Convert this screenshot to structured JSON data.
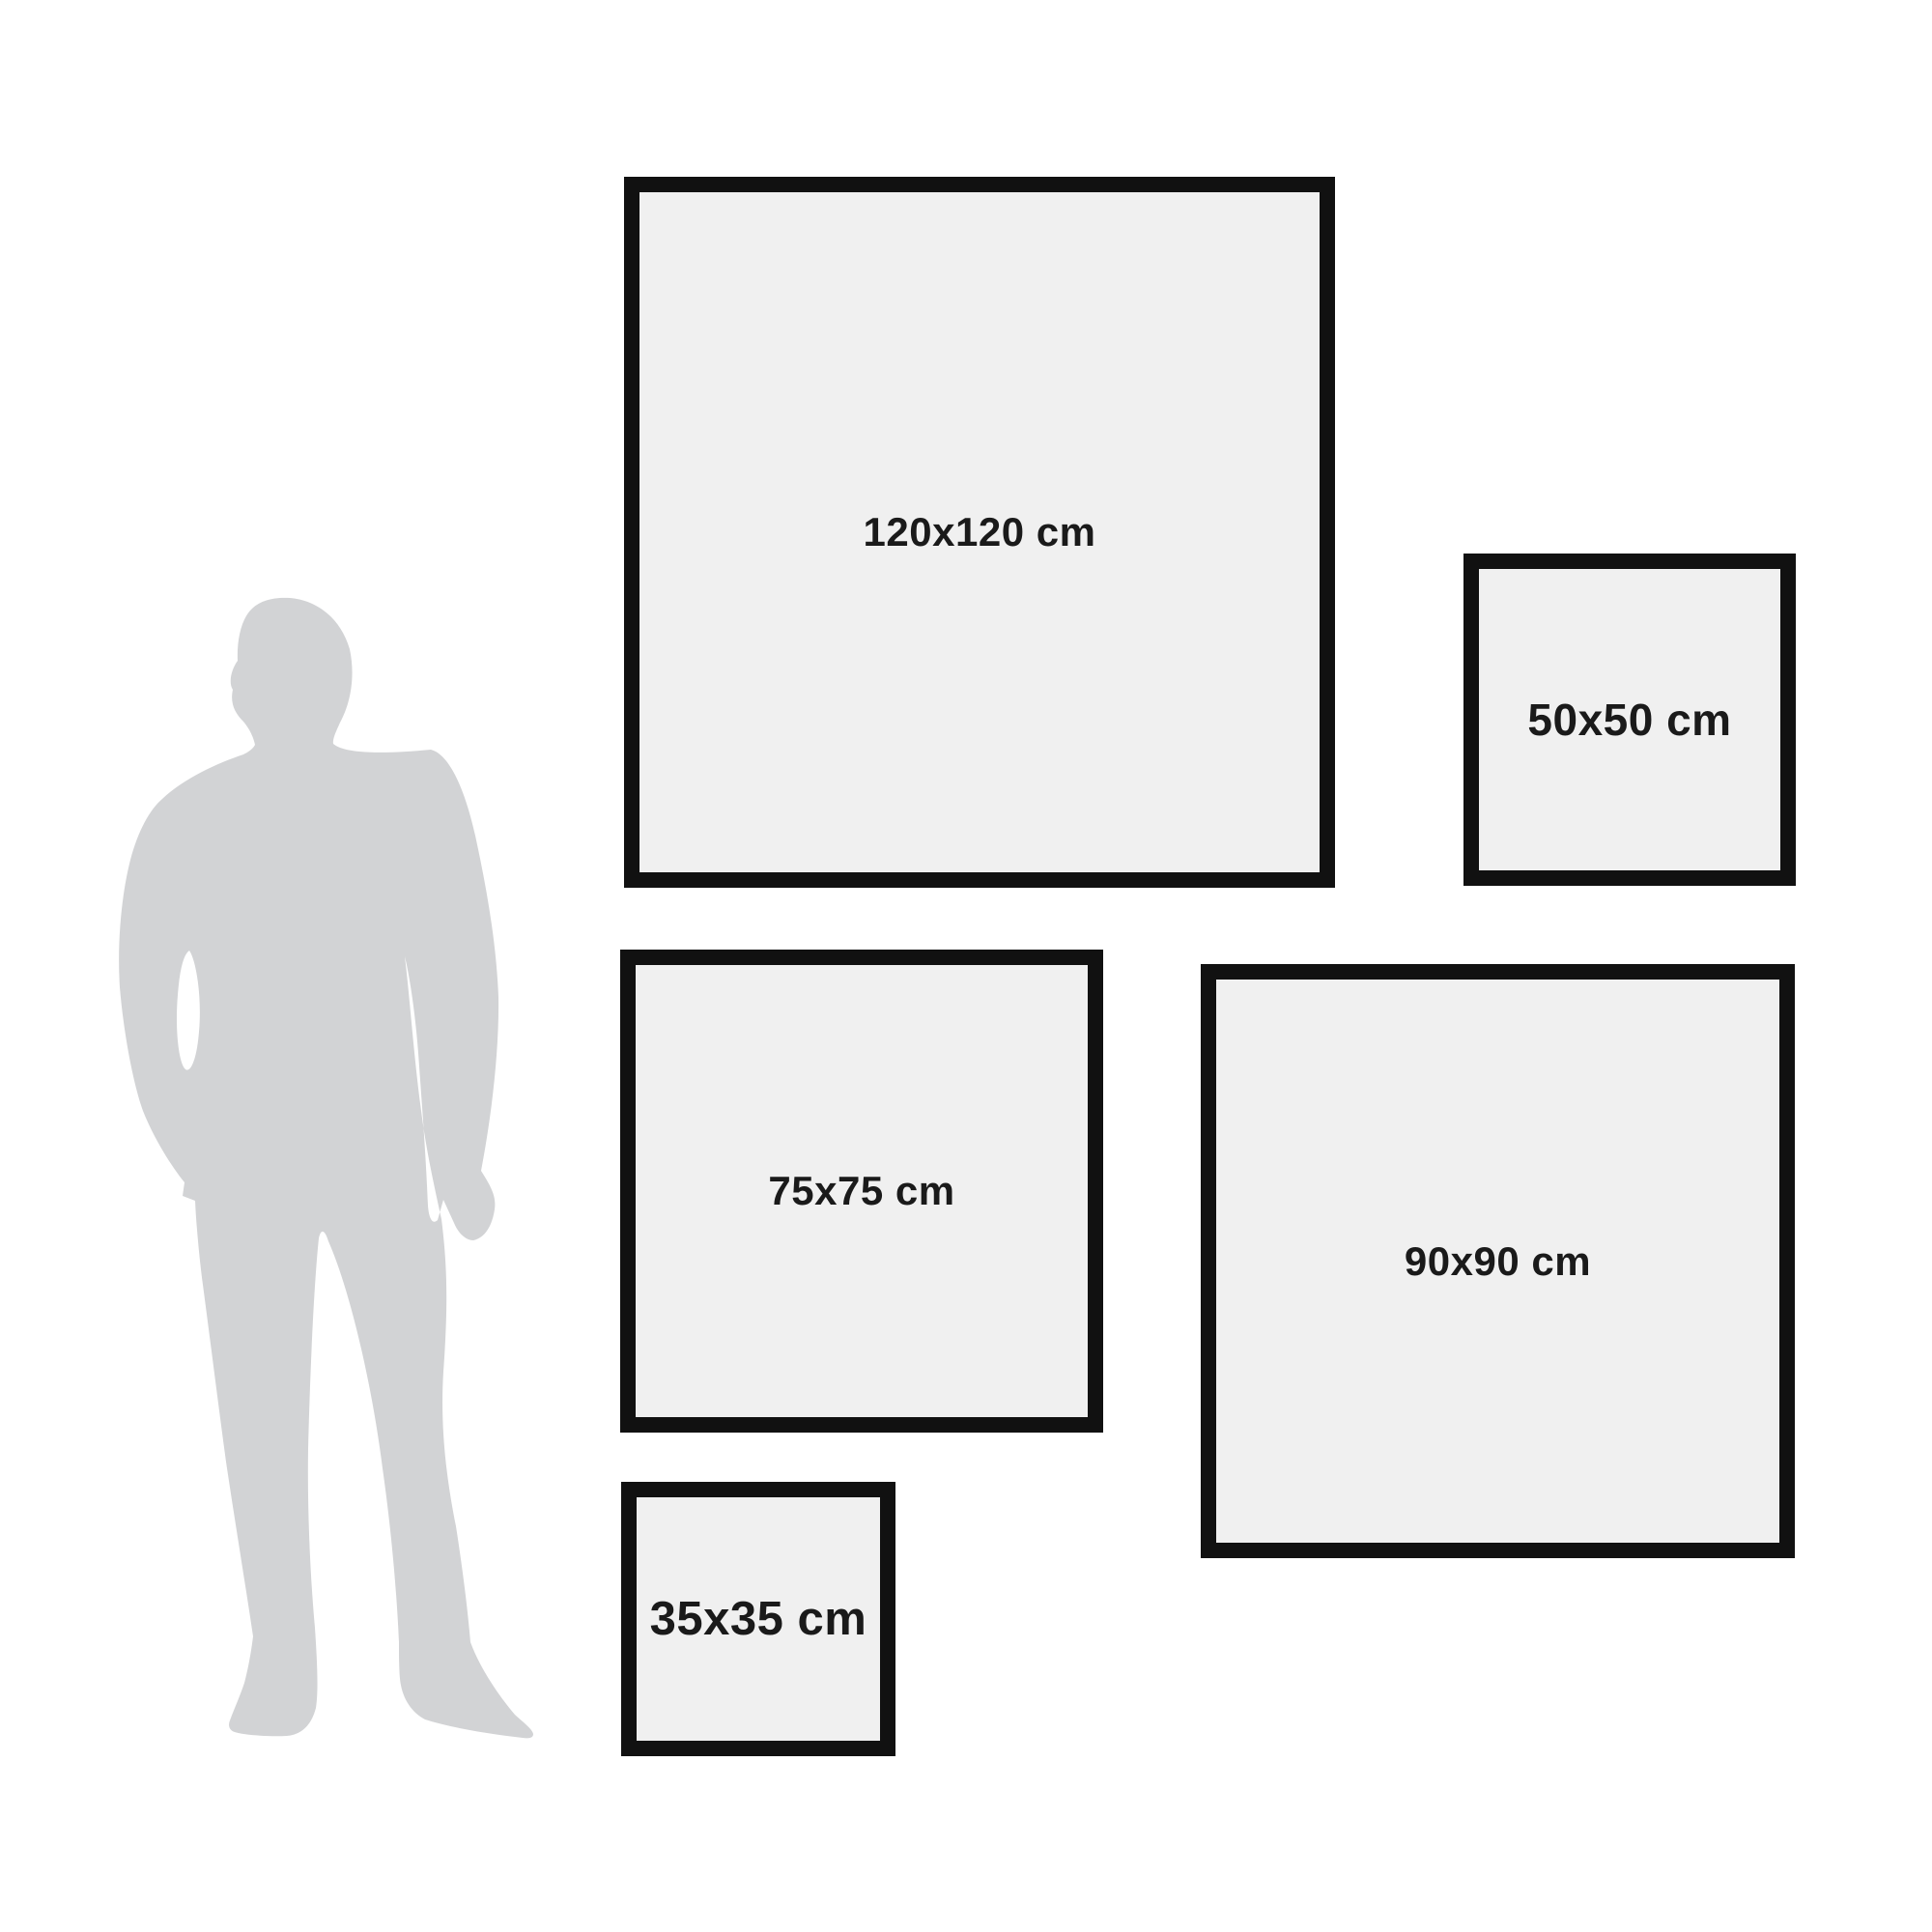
{
  "silhouette": {
    "icon": "standing-man-silhouette-icon",
    "color": "#d2d3d5"
  },
  "frames": [
    {
      "id": "120",
      "label": "120x120 cm"
    },
    {
      "id": "50",
      "label": "50x50 cm"
    },
    {
      "id": "75",
      "label": "75x75 cm"
    },
    {
      "id": "90",
      "label": "90x90 cm"
    },
    {
      "id": "35",
      "label": "35x35 cm"
    }
  ],
  "colors": {
    "background": "#ffffff",
    "frame_border": "#111111",
    "frame_fill": "#f0f0f0",
    "label_text": "#1a1a1a"
  }
}
